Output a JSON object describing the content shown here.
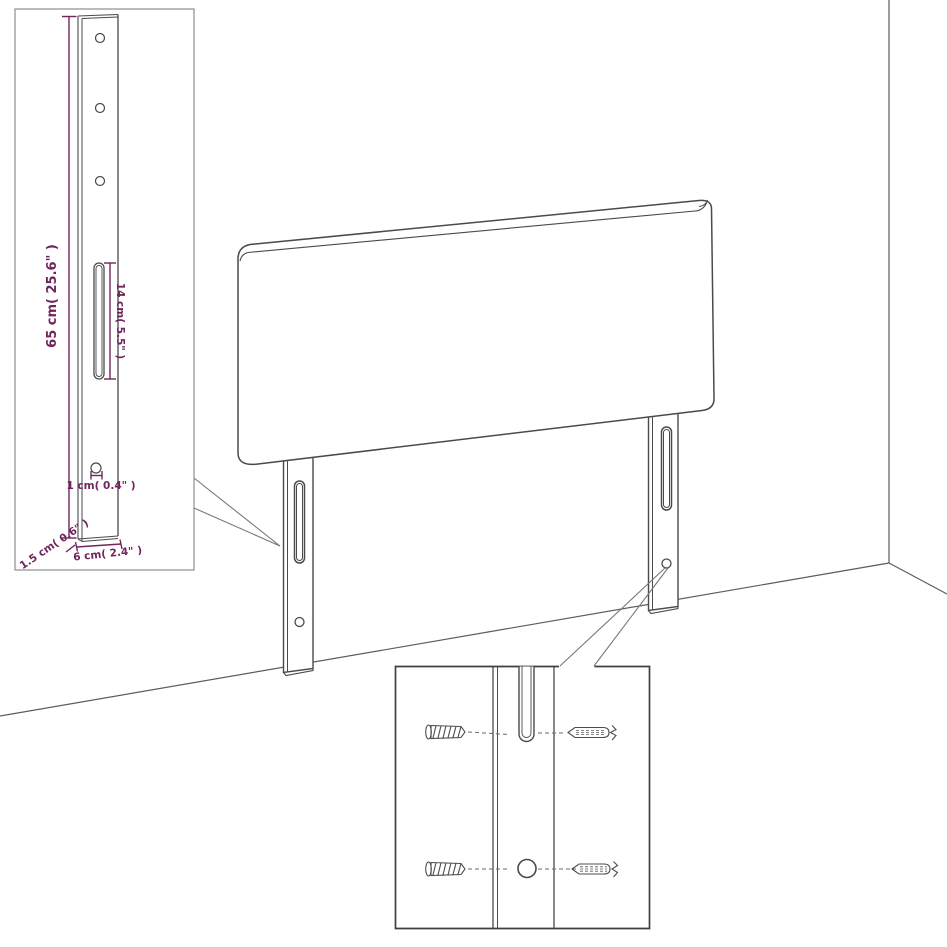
{
  "diagram": {
    "labels": {
      "leg_height": "65 cm( 25.6\" )",
      "slot_length": "14 cm( 5.5\" )",
      "hole_diameter": "1 cm( 0.4\" )",
      "leg_thickness": "1.5 cm( 0.6\" )",
      "leg_width": "6 cm( 2.4\" )"
    },
    "colors": {
      "dimension_text": "#70265c",
      "line_ink": "#4a4a4a",
      "inset_border_light": "#8e8e8e",
      "inset_border_dark": "#3f3f3f",
      "background": "#ffffff"
    }
  }
}
